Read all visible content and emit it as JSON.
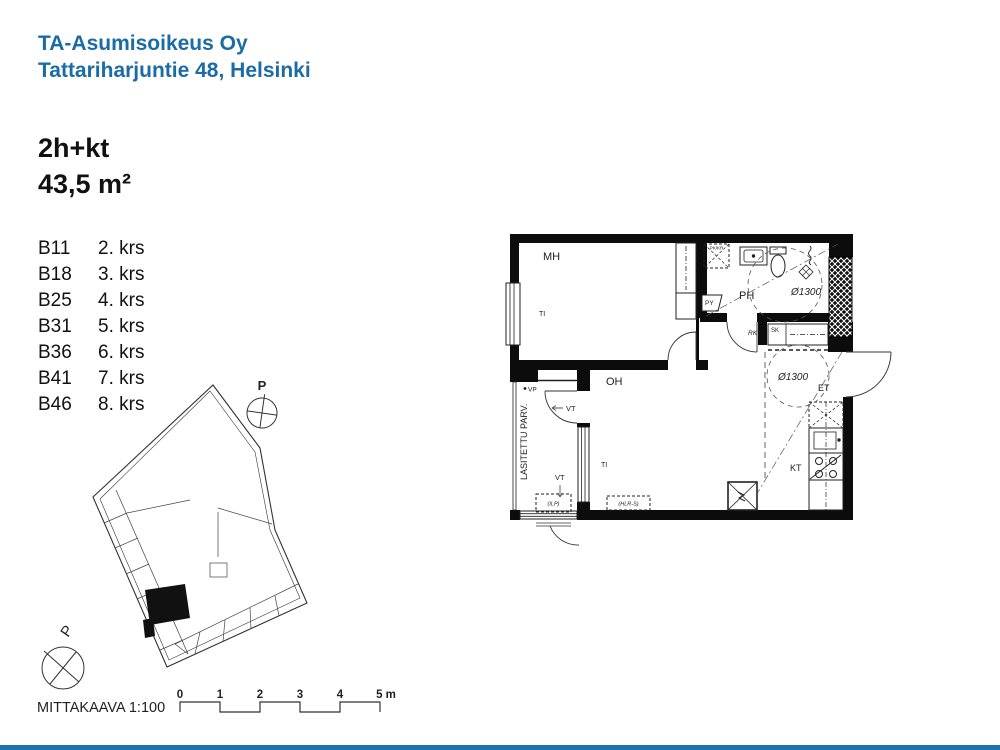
{
  "header": {
    "line1": "TA-Asumisoikeus Oy",
    "line2": "Tattariharjuntie 48, Helsinki"
  },
  "apartment": {
    "type": "2h+kt",
    "area": "43,5 m²"
  },
  "units": [
    {
      "code": "B11",
      "floor": "2. krs"
    },
    {
      "code": "B18",
      "floor": "3. krs"
    },
    {
      "code": "B25",
      "floor": "4. krs"
    },
    {
      "code": "B31",
      "floor": "5. krs"
    },
    {
      "code": "B36",
      "floor": "6. krs"
    },
    {
      "code": "B41",
      "floor": "7. krs"
    },
    {
      "code": "B46",
      "floor": "8. krs"
    }
  ],
  "plan": {
    "bedroom": "MH",
    "bathroom": "PH",
    "living_room": "OH",
    "entry": "ET",
    "kitchen": "KT",
    "closet": "SK",
    "electrical_panel": "RK",
    "laundry": "PY",
    "window_label_1": "TI",
    "window_label_2": "TI",
    "vent_label_1": "VT",
    "vent_label_2": "VT",
    "water_point": "VP",
    "glazed_balcony": "LASITETTU PARV.",
    "turning_circle_1": "Ø1300",
    "turning_circle_2": "Ø1300",
    "washer_reservation": "PK/KR",
    "heatpump_reservation": "(ILP)",
    "reservation_2": "(HLR-S)"
  },
  "site_plan": {
    "north_1": "P",
    "north_2": "P"
  },
  "scale_bar": {
    "label": "MITTAKAAVA 1:100",
    "ticks": [
      "0",
      "1",
      "2",
      "3",
      "4",
      "5 m"
    ]
  },
  "colors": {
    "accent": "#1a6ba6",
    "bar": "#1e73ad"
  }
}
